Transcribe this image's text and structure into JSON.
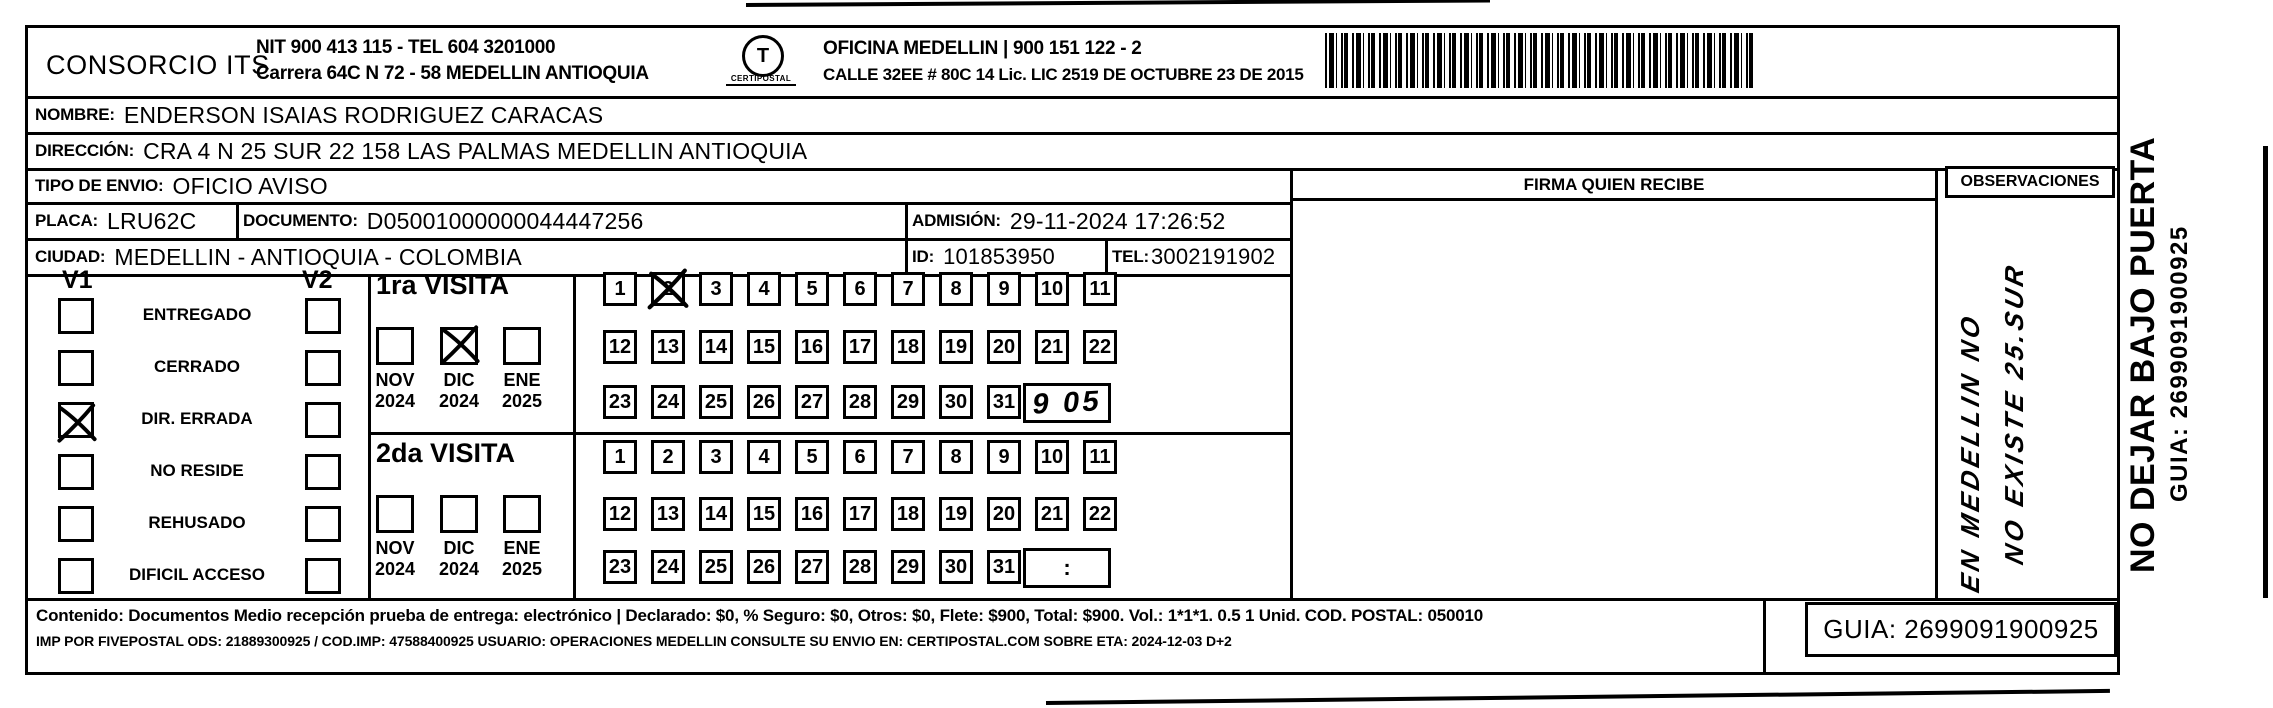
{
  "header": {
    "company": "CONSORCIO ITS",
    "nit_line": "NIT 900 413 115 - TEL 604 3201000",
    "address_line": "Carrera 64C N 72 - 58 MEDELLIN ANTIOQUIA",
    "logo_glyph": "T",
    "logo_caption": "CERTIPOSTAL",
    "office_line": "OFICINA MEDELLIN | 900 151 122 - 2",
    "office_address": "CALLE 32EE # 80C 14 Lic. LIC 2519 DE OCTUBRE 23 DE 2015"
  },
  "fields": {
    "nombre": {
      "label": "NOMBRE:",
      "value": "ENDERSON ISAIAS RODRIGUEZ CARACAS"
    },
    "direccion": {
      "label": "DIRECCIÓN:",
      "value": "CRA 4 N 25 SUR 22 158 LAS PALMAS  MEDELLIN ANTIOQUIA"
    },
    "tipo_envio": {
      "label": "TIPO DE ENVIO:",
      "value": "OFICIO AVISO"
    },
    "placa": {
      "label": "PLACA:",
      "value": "LRU62C"
    },
    "documento": {
      "label": "DOCUMENTO:",
      "value": "D05001000000044447256"
    },
    "admision": {
      "label": "ADMISIÓN:",
      "value": "29-11-2024 17:26:52"
    },
    "ciudad": {
      "label": "CIUDAD:",
      "value": "MEDELLIN - ANTIOQUIA - COLOMBIA"
    },
    "id": {
      "label": "ID:",
      "value": "101853950"
    },
    "tel": {
      "label": "TEL:",
      "value": "3002191902"
    }
  },
  "status_panel": {
    "col1_header": "V1",
    "col2_header": "V2",
    "rows": [
      {
        "label": "ENTREGADO",
        "v1_checked": false,
        "v2_checked": false
      },
      {
        "label": "CERRADO",
        "v1_checked": false,
        "v2_checked": false
      },
      {
        "label": "DIR. ERRADA",
        "v1_checked": true,
        "v2_checked": false
      },
      {
        "label": "NO RESIDE",
        "v1_checked": false,
        "v2_checked": false
      },
      {
        "label": "REHUSADO",
        "v1_checked": false,
        "v2_checked": false
      },
      {
        "label": "DIFICIL ACCESO",
        "v1_checked": false,
        "v2_checked": false
      }
    ]
  },
  "calendar_days": [
    "1",
    "2",
    "3",
    "4",
    "5",
    "6",
    "7",
    "8",
    "9",
    "10",
    "11",
    "12",
    "13",
    "14",
    "15",
    "16",
    "17",
    "18",
    "19",
    "20",
    "21",
    "22",
    "23",
    "24",
    "25",
    "26",
    "27",
    "28",
    "29",
    "30",
    "31"
  ],
  "visits": [
    {
      "title": "1ra VISITA",
      "months": [
        {
          "month": "NOV",
          "year": "2024",
          "checked": false
        },
        {
          "month": "DIC",
          "year": "2024",
          "checked": true
        },
        {
          "month": "ENE",
          "year": "2025",
          "checked": false
        }
      ],
      "crossed_days": [
        2
      ],
      "time_box": "9 05",
      "time_handwritten": true
    },
    {
      "title": "2da VISITA",
      "months": [
        {
          "month": "NOV",
          "year": "2024",
          "checked": false
        },
        {
          "month": "DIC",
          "year": "2024",
          "checked": false
        },
        {
          "month": "ENE",
          "year": "2025",
          "checked": false
        }
      ],
      "crossed_days": [],
      "time_box": ":",
      "time_handwritten": false
    }
  ],
  "signature": {
    "header": "FIRMA QUIEN RECIBE"
  },
  "observations": {
    "header": "OBSERVACIONES",
    "handwriting": [
      "EN MEDELLIN NO",
      "NO EXISTE 25.SUR"
    ]
  },
  "side_text": {
    "warning": "NO DEJAR BAJO PUERTA",
    "guia": "GUIA: 2699091900925"
  },
  "footer": {
    "line1": "Contenido: Documentos Medio recepción prueba de entrega: electrónico | Declarado: $0, % Seguro: $0, Otros: $0, Flete: $900, Total: $900. Vol.: 1*1*1. 0.5  1 Unid. COD. POSTAL: 050010",
    "line2": "IMP POR FIVEPOSTAL ODS: 21889300925 / COD.IMP: 47588400925 USUARIO: OPERACIONES MEDELLIN CONSULTE SU ENVIO EN: CERTIPOSTAL.COM SOBRE ETA: 2024-12-03 D+2",
    "guia_box": "GUIA: 2699091900925"
  }
}
